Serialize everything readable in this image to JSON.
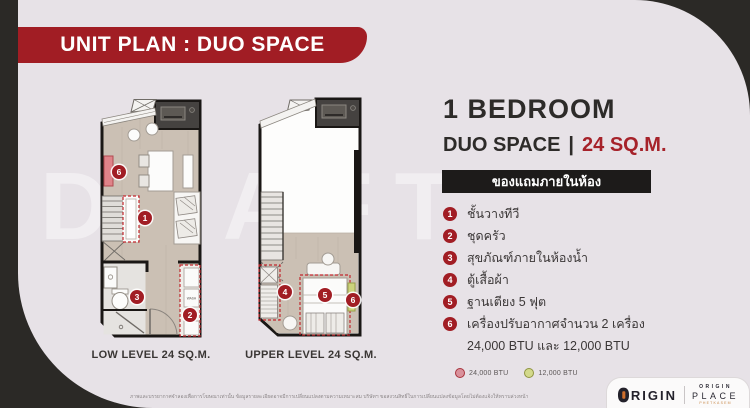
{
  "banner": {
    "title": "UNIT PLAN : DUO SPACE"
  },
  "unit": {
    "bedroom_title": "1 BEDROOM",
    "type_label": "DUO SPACE",
    "separator": "|",
    "area_label": "24 SQ.M.",
    "freebies_header": "ของแถมภายในห้อง"
  },
  "legend": {
    "items": [
      {
        "num": "1",
        "label": "ชั้นวางทีวี"
      },
      {
        "num": "2",
        "label": "ชุดครัว"
      },
      {
        "num": "3",
        "label": "สุขภัณฑ์ภายในห้องน้ำ"
      },
      {
        "num": "4",
        "label": "ตู้เสื้อผ้า"
      },
      {
        "num": "5",
        "label": "ฐานเตียง 5 ฟุต"
      },
      {
        "num": "6",
        "label": "เครื่องปรับอากาศจำนวน 2 เครื่อง",
        "label2": "24,000 BTU และ 12,000 BTU"
      }
    ],
    "btu_dots": [
      {
        "label": "24,000 BTU",
        "color": "#d9919b",
        "border": "#a8323c"
      },
      {
        "label": "12,000 BTU",
        "color": "#d3d98b",
        "border": "#8f9440"
      }
    ]
  },
  "plans": {
    "watermark": "DRAFT",
    "wash_label": "WASH",
    "low_label": "LOW LEVEL 24 SQ.M.",
    "upper_label": "UPPER LEVEL 24 SQ.M.",
    "markers": [
      {
        "num": "6",
        "x": 101,
        "y": 172
      },
      {
        "num": "1",
        "x": 127,
        "y": 218
      },
      {
        "num": "3",
        "x": 119,
        "y": 297
      },
      {
        "num": "2",
        "x": 172,
        "y": 315
      },
      {
        "num": "4",
        "x": 267,
        "y": 292
      },
      {
        "num": "5",
        "x": 307,
        "y": 295
      },
      {
        "num": "6",
        "x": 335,
        "y": 300
      }
    ]
  },
  "footer": {
    "disclaimer": "ภาพและบรรยากาศจำลองเพื่อการโฆษณาเท่านั้น ข้อมูลรายละเอียดอาจมีการเปลี่ยนแปลงตามความเหมาะสม บริษัทฯ ขอสงวนสิทธิ์ในการเปลี่ยนแปลงข้อมูลโดยไม่ต้องแจ้งให้ทราบล่วงหน้า",
    "logo": {
      "brand": "RIGIN",
      "project_line1": "ORIGIN",
      "project_line2": "PLACE",
      "project_line3": "PHETKASEM"
    }
  },
  "colors": {
    "accent_red": "#a11d24",
    "dark_background": "#2b2926",
    "panel_background": "#e7e2e7",
    "black_bar": "#1d1b1a",
    "dashed_red": "#c1272d"
  }
}
